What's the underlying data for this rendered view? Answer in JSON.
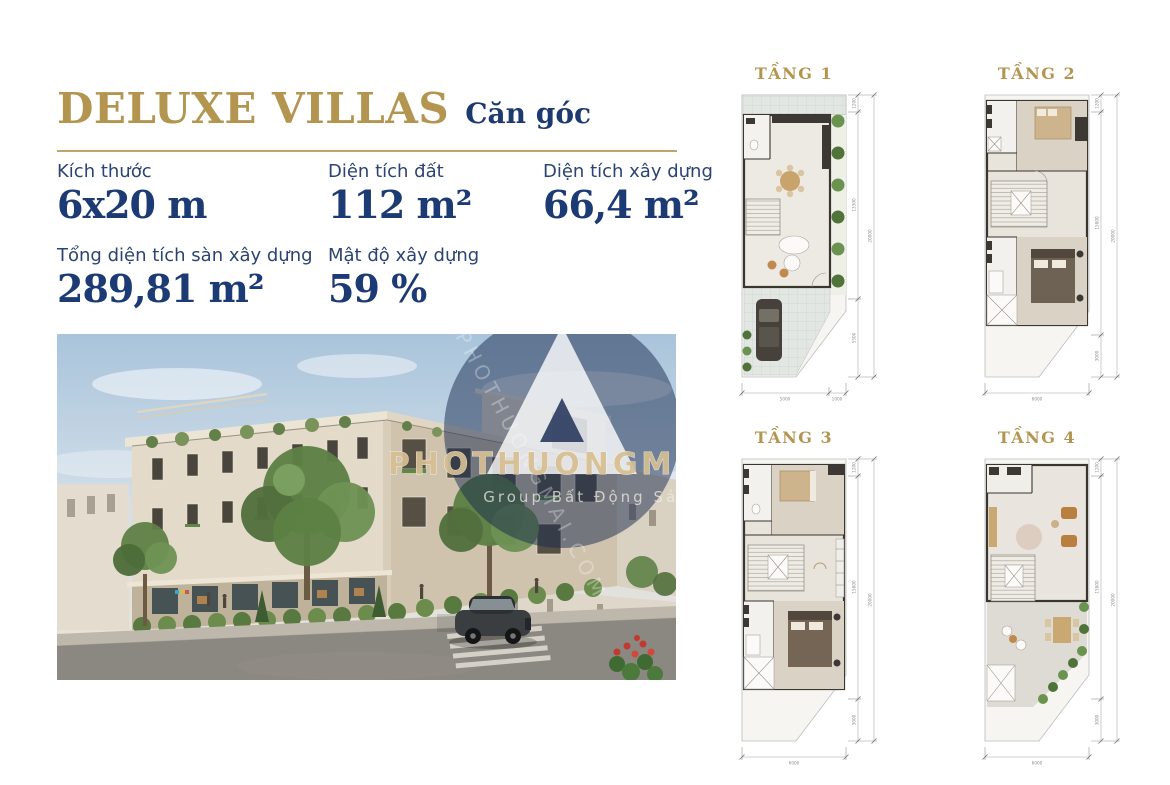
{
  "colors": {
    "gold": "#b3954f",
    "navy": "#1c3a74",
    "label_navy": "#2b4472"
  },
  "header": {
    "title": "DELUXE VILLAS",
    "subtitle": "Căn góc"
  },
  "specs": {
    "row1": [
      {
        "label": "Kích thước",
        "value": "6x20 m"
      },
      {
        "label": "Diện tích đất",
        "value": "112 m²"
      },
      {
        "label": "Diện tích xây dựng",
        "value": "66,4 m²"
      }
    ],
    "row2": [
      {
        "label": "Tổng diện tích sàn xây dựng",
        "value": "289,81 m²"
      },
      {
        "label": "Mật độ xây dựng",
        "value": "59 %"
      }
    ]
  },
  "photo": {
    "watermark_line1": "PHOTHUONGMAI.COM",
    "watermark_line2": "Group Bất Động Sản"
  },
  "floorplans": [
    {
      "label": "TẦNG 1",
      "dims_right": [
        "1200",
        "13300",
        "5500"
      ],
      "dim_total": "20000",
      "dims_bottom": [
        "5000",
        "1000"
      ]
    },
    {
      "label": "TẦNG 2",
      "dims_right": [
        "1200",
        "15800",
        "3000"
      ],
      "dim_total": "20000",
      "dims_bottom": [
        "6000"
      ]
    },
    {
      "label": "TẦNG 3",
      "dims_right": [
        "1200",
        "15800",
        "3000"
      ],
      "dim_total": "20000",
      "dims_bottom": [
        "6000"
      ]
    },
    {
      "label": "TẦNG 4",
      "dims_right": [
        "1200",
        "15800",
        "3000"
      ],
      "dim_total": "20000",
      "dims_bottom": [
        "6000"
      ]
    }
  ]
}
